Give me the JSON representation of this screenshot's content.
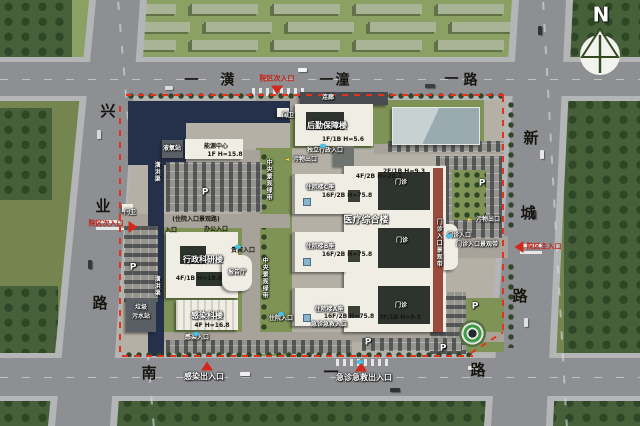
{
  "north_indicator": {
    "label": "N"
  },
  "roads": {
    "dash": "一",
    "north": {
      "name": "潢潼路",
      "c1": "潢",
      "c2": "潼",
      "c3": "路"
    },
    "west": {
      "name": "兴业路",
      "c1": "兴",
      "c2": "业",
      "c3": "路"
    },
    "east": {
      "name": "新城路",
      "c1": "新",
      "c2": "城",
      "c3": "路"
    },
    "south": {
      "name": "南一路",
      "c1": "南",
      "c2": "一",
      "c3": "路"
    }
  },
  "gates": {
    "north_secondary": "院区次入口",
    "west_secondary": "院区次入口",
    "east_main": "院区主入口",
    "infection": "感染出入口",
    "emergency": "急诊急救出入口"
  },
  "buildings": {
    "logistics": {
      "name": "后勤保障楼",
      "spec": "1F/1B H=5.6"
    },
    "corridor": {
      "name": "连廊"
    },
    "guard": {
      "name": "门卫"
    },
    "energy": {
      "name": "能源中心",
      "spec": "1F H=15.8"
    },
    "lox": {
      "name": "液氧站"
    },
    "admin": {
      "name": "行政科研楼",
      "spec": "4F/1B H=18.6"
    },
    "lecture": {
      "name": "报告厅"
    },
    "infection": {
      "name": "感染科楼",
      "spec": "4F H=16.8"
    },
    "waste": {
      "name": "垃圾污水站",
      "l1": "垃圾",
      "l2": "污水站"
    },
    "complex": {
      "name": "医疗综合楼"
    },
    "inpatient_c": {
      "name": "住院楼C座",
      "spec": "16F/2B H=75.8"
    },
    "inpatient_b": {
      "name": "住院楼B座",
      "spec": "16F/2B H=75.8"
    },
    "inpatient_a": {
      "name": "住院楼A座",
      "spec": "16F/2B H=75.8"
    },
    "outpatient": {
      "name": "门诊",
      "spec_north": "2F/1B H=9.3",
      "spec_mid": "4F/2B H=20.1",
      "spec_south": "3F/1B H=9.3"
    }
  },
  "site_labels": {
    "canal": "潢洪渠",
    "green_axis": "中央景观绿带",
    "inpatient_road": "(住院入口景观路)",
    "outpatient_belt": "门诊入口景观带",
    "entrance": "入口",
    "office_entrance": "办公入口",
    "vip_entrance": "贵宾入口",
    "admin_entrance": "独立行政入口",
    "outpatient_entrance": "门诊入口",
    "inpatient_entrance": "住院入口",
    "emergency_entrance": "急诊急救入口",
    "infection_entrance": "感染入口",
    "waste_exit": "污物出口",
    "parking": "P"
  },
  "colors": {
    "boundary_red": "#e2331f",
    "gate_red": "#c81e12",
    "road_gray": "#8d8f92",
    "grass_green": "#74854f",
    "canal_navy": "#25304a",
    "building_white": "#f0ede5",
    "glass_blue": "#aeb9bd",
    "helipad_green": "#3f9b4c",
    "marker_cyan": "#49c3e8"
  }
}
